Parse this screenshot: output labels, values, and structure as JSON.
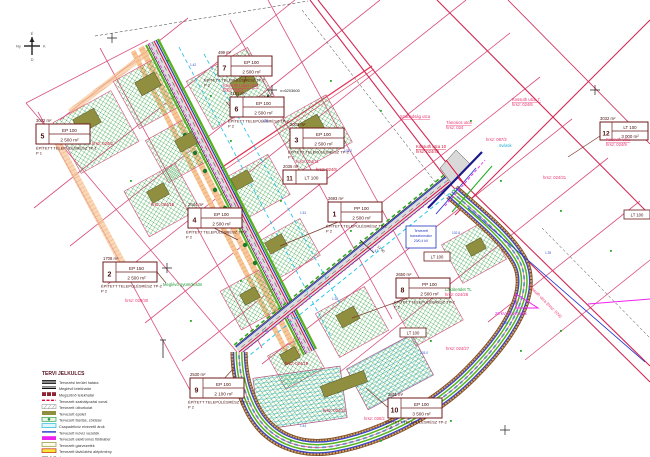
{
  "palette": {
    "parcel_line": "#d94f7e",
    "boundary_red": "#d22a55",
    "road_gray": "#dcdcdc",
    "building_olive": "#8f8f3f",
    "hatch_green": "#2e9e44",
    "utility_blue": "#2233cc",
    "utility_magenta": "#ee22ee",
    "band_orange": "#f2a45f",
    "band_tan": "#c89a66",
    "band_green": "#57b21f",
    "ditch_cyan": "#18c0e8",
    "line_red": "#e60039",
    "label_pink": "#e8336e",
    "label_blue": "#3355cc",
    "label_green": "#1a9933"
  },
  "compass": {
    "n": "É",
    "e": "K",
    "s": "D",
    "w": "Ny"
  },
  "coord_cross_label": "x=6203600",
  "dim_road_a": "16 00",
  "dim_road_b": "12 00",
  "legend": {
    "title": "TERVI JELKULCS",
    "items": [
      {
        "label": "Tervezési terület határa",
        "color": "#111111"
      },
      {
        "label": "Meglévő telekhatár",
        "color": "#111111"
      },
      {
        "label": "Megszűnő telekhatár",
        "color": "#8c2433"
      },
      {
        "label": "Tervezett szabályozási vonal",
        "color": "#e60039"
      },
      {
        "label": "Tervezett útburkolat",
        "color": "#9a9a9a"
      },
      {
        "label": "Tervezett épület",
        "color": "#8f8f3f"
      },
      {
        "label": "Tervezett fásítás, zöldsáv",
        "color": "#2e9e44"
      },
      {
        "label": "Csapadékvíz elvezető árok",
        "color": "#24b8d8"
      },
      {
        "label": "Tervezett ivóvíz vezeték",
        "color": "#2233cc"
      },
      {
        "label": "Tervezett elektromos földkábel",
        "color": "#ee22ee"
      },
      {
        "label": "Tervezett gázvezeték",
        "color": "#8f8f3f"
      },
      {
        "label": "Tervezett távközlési alépítmény",
        "color": "#f5e63c"
      },
      {
        "label": "Építési hely határa",
        "color": "#333333"
      }
    ]
  },
  "zone_boxes": [
    {
      "num": "5",
      "code": "EP 100",
      "area": "2 500 m²",
      "parcel": "3032 m²",
      "caption": "ÉPÍTETT TELEPÜLÉSRÉSZ TP-1",
      "note": "P 1"
    },
    {
      "num": "7",
      "code": "EP 100",
      "area": "2 500 m²",
      "parcel": "499 m²",
      "caption": "ÉPÍTETT TELEPÜLÉSRÉSZ TP-2",
      "note": "P 2"
    },
    {
      "num": "6",
      "code": "EP 100",
      "area": "2 500 m²",
      "parcel": "4191 m²",
      "caption": "ÉPÍTETT TELEPÜLÉSRÉSZ TP-2",
      "note": "P 2"
    },
    {
      "num": "3",
      "code": "EP 100",
      "area": "2 500 m²",
      "parcel": "2003 m²",
      "caption": "ÉPÍTETT TELEPÜLÉSRÉSZ TP-2",
      "note": "P 2"
    },
    {
      "num": "11",
      "code": "LT 100",
      "area": "2 500 m²",
      "parcel": "2036 m²",
      "caption": "",
      "note": ""
    },
    {
      "num": "1",
      "code": "PP 100",
      "area": "2 500 m²",
      "parcel": "2693 m²",
      "caption": "ÉPÍTETT TELEPÜLÉSRÉSZ TP-2",
      "note": "P 2"
    },
    {
      "num": "4",
      "code": "EP 100",
      "area": "2 500 m²",
      "parcel": "2044 m²",
      "caption": "ÉPÍTETT TELEPÜLÉSRÉSZ TP-2",
      "note": "P 2"
    },
    {
      "num": "2",
      "code": "EP 150",
      "area": "2 500 m²",
      "parcel": "1708 m²",
      "caption": "ÉPÍTETT TELEPÜLÉSRÉSZ TP-2",
      "note": "P 2"
    },
    {
      "num": "8",
      "code": "PP 100",
      "area": "2 500 m²",
      "parcel": "2650 m²",
      "caption": "ÉPÍTETT TELEPÜLÉSRÉSZ TP-2",
      "note": "P 2"
    },
    {
      "num": "9",
      "code": "EP 100",
      "area": "2 100 m²",
      "parcel": "2530 m²",
      "caption": "ÉPÍTETT TELEPÜLÉSRÉSZ TP-2",
      "note": "P 2"
    },
    {
      "num": "10",
      "code": "EP 100",
      "area": "3 500 m²",
      "parcel": "2811 m²",
      "caption": "ÉPÍTETT TELEPÜLÉSRÉSZ TP-2",
      "note": "P 2"
    },
    {
      "num": "12",
      "code": "LT 100",
      "area": "3 000 m²",
      "parcel": "3032 m²",
      "caption": "",
      "note": ""
    }
  ],
  "mini_boxes": [
    {
      "code": "LT 100"
    },
    {
      "code": "LT 100"
    },
    {
      "code": "LT 100"
    }
  ],
  "transformer": {
    "l1": "Tervezett",
    "l2": "transzformátor",
    "l3": "20/0,4 kV"
  },
  "labels": [
    {
      "text": "Kossuth Lajos utca"
    },
    {
      "text": "hrsz: 024/1"
    },
    {
      "text": "Szabadság utca"
    },
    {
      "text": "Táncsics utca"
    },
    {
      "text": "hrsz: 024"
    },
    {
      "text": "hrsz: 087/2"
    },
    {
      "text": "Kossuth utca 7."
    },
    {
      "text": "hrsz: 024/6"
    },
    {
      "text": "Kossuth utca"
    },
    {
      "text": "hrsz: 024/9"
    },
    {
      "text": "Kossuth utca 10"
    },
    {
      "text": "hrsz: 024/45"
    },
    {
      "text": "Kossuth utca (hrsz: 024)"
    },
    {
      "text": "hrsz: 024/31"
    },
    {
      "text": "Lakóterület TL"
    },
    {
      "text": "hrsz: 024/28"
    },
    {
      "text": "hrsz: 024/27"
    },
    {
      "text": "hrsz: 030/2"
    },
    {
      "text": "hrsz: 024/3"
    },
    {
      "text": "hrsz: 024/15"
    },
    {
      "text": "hrsz: 024/8"
    },
    {
      "text": "hrsz: 024/19"
    },
    {
      "text": "hrsz: 024/21"
    },
    {
      "text": "hrsz: 029/30"
    },
    {
      "text": "Meglévő gyümölcsös"
    },
    {
      "text": "20 kV légvezeték"
    },
    {
      "text": "övárok"
    },
    {
      "text": "hrsz: 024/11"
    }
  ],
  "blue_marks": [
    "1.42",
    "1.38",
    "103.2",
    "1.51",
    "1.47",
    "102.8",
    "1.35",
    "1.60",
    "103.0",
    "1.44",
    "1.56",
    "1.39"
  ]
}
